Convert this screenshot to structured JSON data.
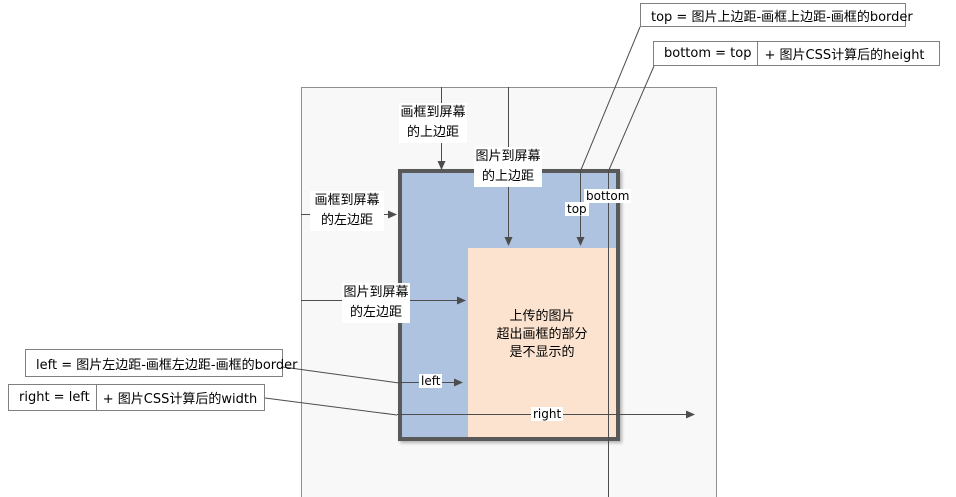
{
  "diagram_title": "image-in-frame CSS position diagram",
  "colors": {
    "frame_fill": "#aec3e0",
    "frame_border": "#595959",
    "image_fill": "#fce3cf",
    "screen_fill": "#f8f8f8",
    "line": "#4d4d4d"
  },
  "formula_boxes": {
    "top": {
      "text": "top = 图片上边距-画框上边距-画框的border"
    },
    "bottom": {
      "prefix": "bottom =  top",
      "suffix": "+ 图片CSS计算后的height"
    },
    "left": {
      "text": "left = 图片左边距-画框左边距-画框的border"
    },
    "right": {
      "prefix": "right =  left",
      "suffix": "+ 图片CSS计算后的width"
    }
  },
  "margin_labels": {
    "frame_top": {
      "line1": "画框到屏幕",
      "line2": "的上边距"
    },
    "image_top": {
      "line1": "图片到屏幕",
      "line2": "的上边距"
    },
    "frame_left": {
      "line1": "画框到屏幕",
      "line2": "的左边距"
    },
    "image_left": {
      "line1": "图片到屏幕",
      "line2": "的左边距"
    }
  },
  "edge_labels": {
    "top": "top",
    "bottom": "bottom",
    "left": "left",
    "right": "right"
  },
  "image_note": {
    "line1": "上传的图片",
    "line2": "超出画框的部分",
    "line3": "是不显示的"
  }
}
